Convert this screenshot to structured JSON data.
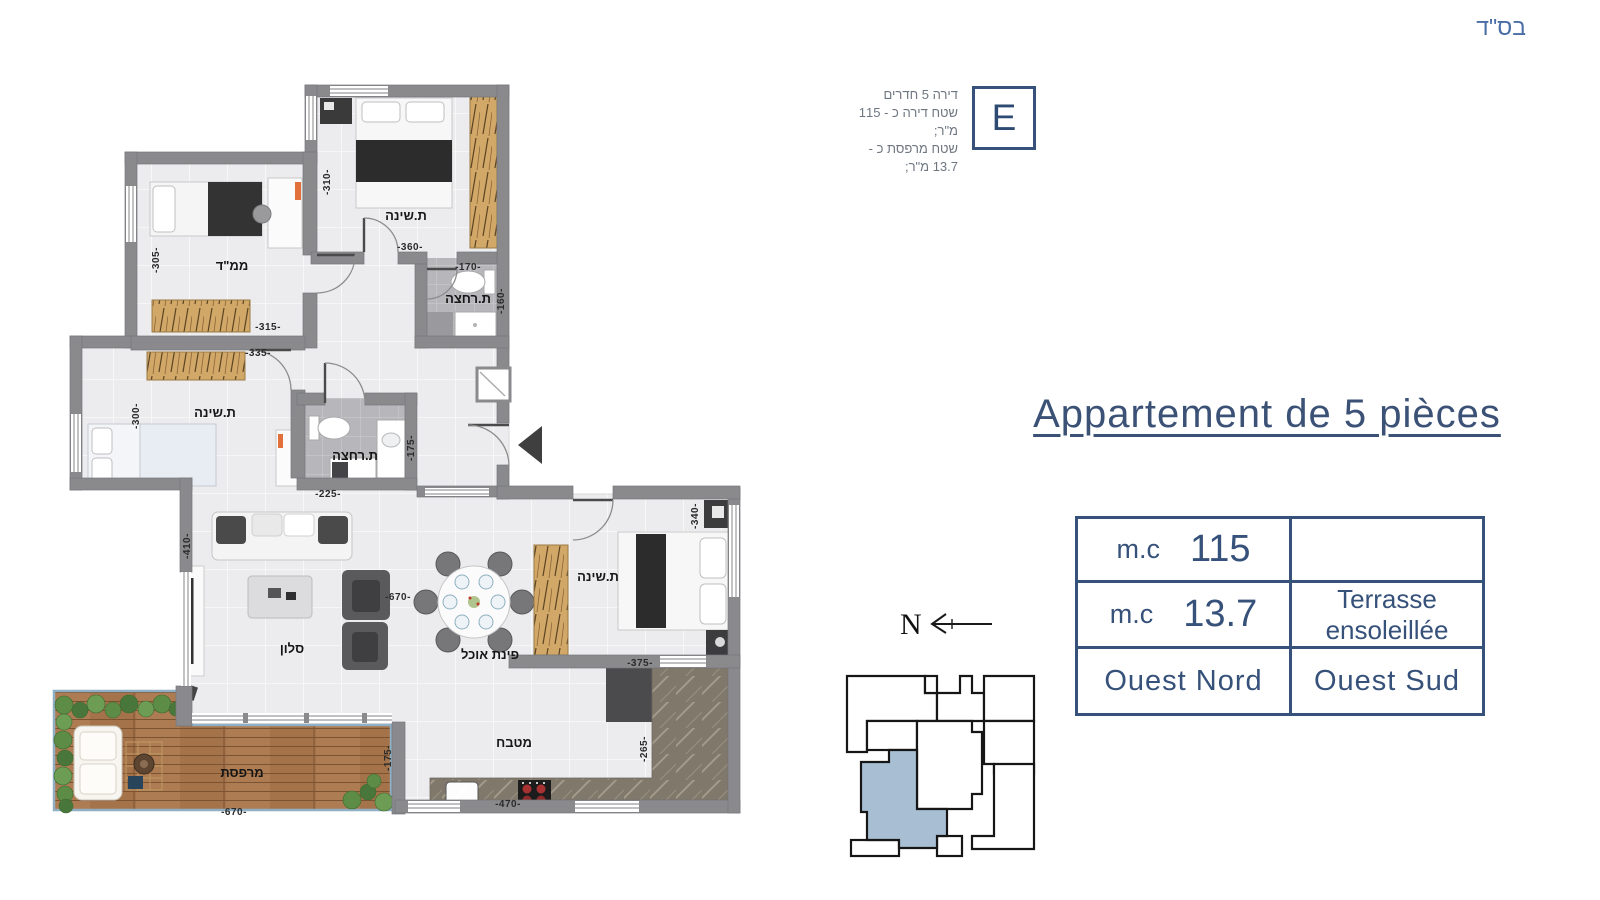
{
  "page": {
    "besed": "בס\"ד"
  },
  "unit_card": {
    "letter": "E",
    "lines": [
      "דירה 5 חדרים",
      "שטח דירה כ - 115 מ\"ר;",
      "שטח מרפסת כ - 13.7 מ\"ר;"
    ]
  },
  "title": {
    "text": "Appartement de 5 pièces"
  },
  "spec_table": {
    "row1": {
      "unit": "m.c",
      "value": "115",
      "right": ""
    },
    "row2": {
      "unit": "m.c",
      "value": "13.7",
      "right_line1": "Terrasse",
      "right_line2": "ensoleillée"
    },
    "row3": {
      "left": "Ouest Nord",
      "right": "Ouest Sud"
    }
  },
  "north": {
    "label": "N"
  },
  "plan": {
    "rooms": {
      "bedroom_top": "ת.שינה",
      "mamad": "ממ\"ד",
      "bath_top": "ת.רחצה",
      "bedroom_left": "ת.שינה",
      "bath_mid": "ת.רחצה",
      "salon": "סלון",
      "dining": "פינת אוכל",
      "bedroom_right": "ת.שינה",
      "kitchen": "מטבח",
      "terrace": "מרפסת"
    },
    "dims": {
      "d310": "-310-",
      "d360": "-360-",
      "d305": "-305-",
      "d315": "-315-",
      "d170": "-170-",
      "d160": "-160-",
      "d335": "-335-",
      "d300": "-300-",
      "d175a": "-175-",
      "d225": "-225-",
      "d410": "-410-",
      "d670a": "-670-",
      "d340": "-340-",
      "d375": "-375-",
      "d470": "-470-",
      "d265": "-265-",
      "d175b": "-175-",
      "d670b": "-670-"
    }
  },
  "colors": {
    "accent": "#36517a",
    "wall": "#8a8a8c",
    "floor": "#ececee",
    "wood": "#d2a868",
    "deck": "#a5734a",
    "key_unit_fill": "#a8bfd3"
  }
}
